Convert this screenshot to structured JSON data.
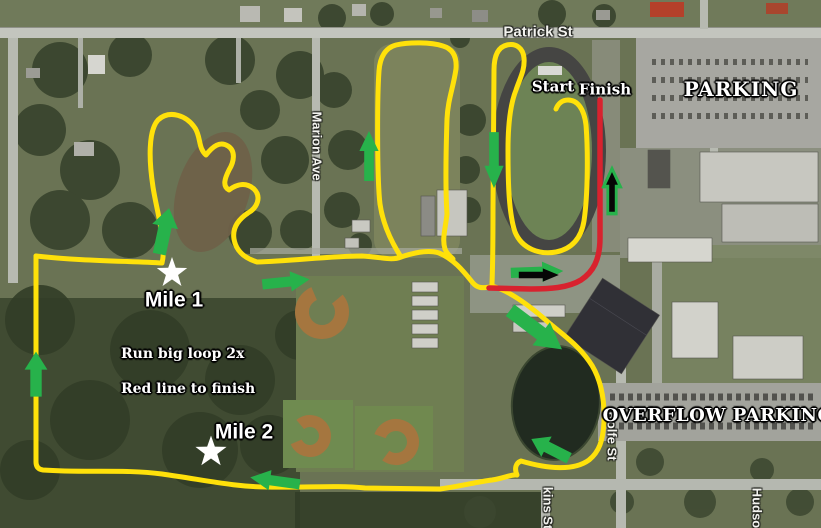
{
  "map": {
    "streets": {
      "patrick": "Patrick St",
      "marion": "Marion Ave",
      "rolfe": "Rolfe St",
      "kins": "kins St",
      "hudson": "Hudson"
    },
    "areas": {
      "parking": "PARKING",
      "overflow": "OVERFLOW PARKING"
    },
    "course": {
      "start": "Start",
      "finish": "Finish",
      "mile1": "Mile 1",
      "mile2": "Mile 2",
      "note1": "Run big loop 2x",
      "note2": "Red line to finish"
    },
    "colors": {
      "route_yellow": "#ffe10a",
      "finish_red": "#d8222e",
      "arrow_green": "#27b24b",
      "arrow_black": "#060606",
      "star_white": "#ffffff"
    }
  }
}
